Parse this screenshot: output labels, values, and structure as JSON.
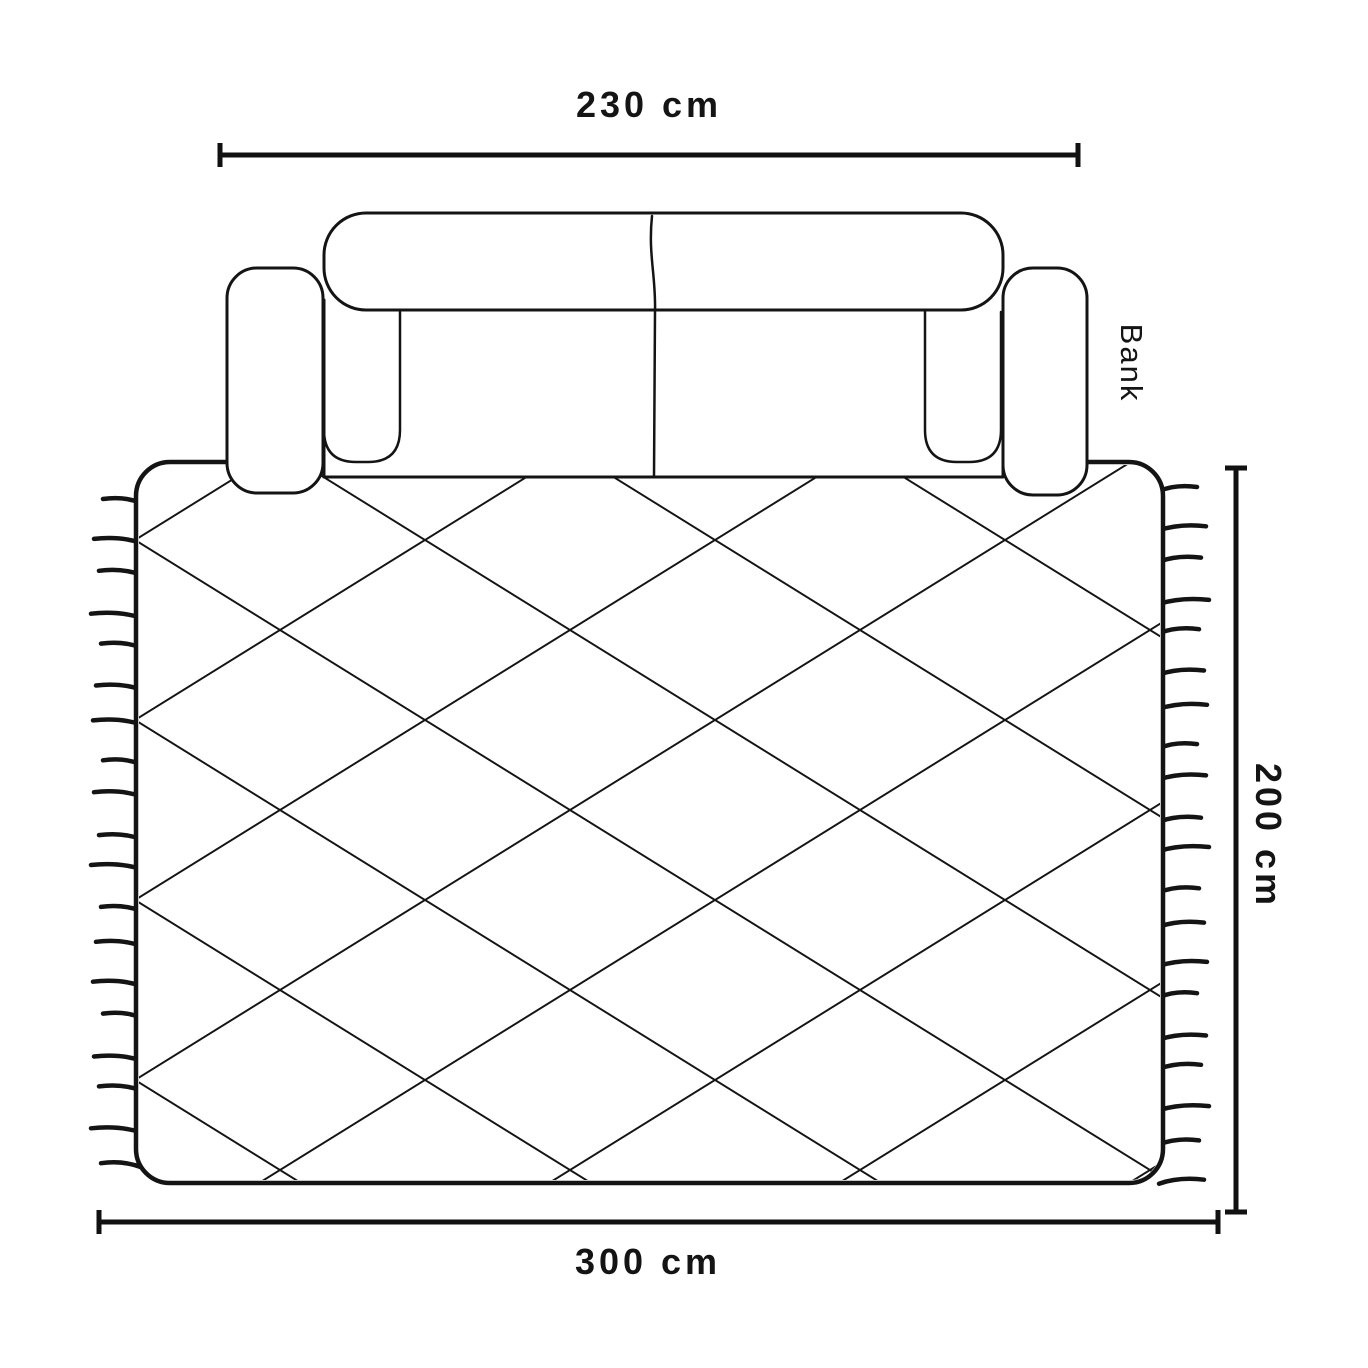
{
  "diagram": {
    "type": "rug-size-guide",
    "dimensions": {
      "sofa_width": "230 cm",
      "rug_width": "300 cm",
      "rug_height": "200 cm"
    },
    "labels": {
      "sofa": "Bank"
    },
    "colors": {
      "line": "#141414",
      "background": "#ffffff"
    }
  }
}
